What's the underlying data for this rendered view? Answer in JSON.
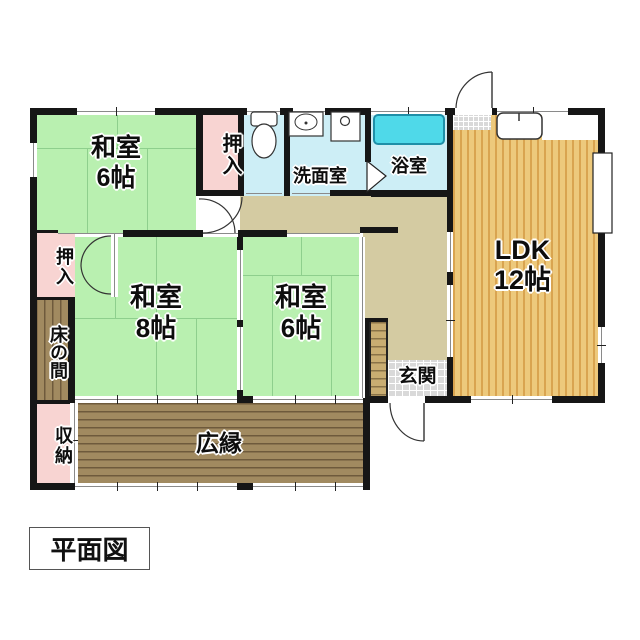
{
  "title_box": {
    "label": "平面図"
  },
  "rooms": {
    "washitsu6_top": {
      "name": "和室",
      "size": "6帖"
    },
    "oshiire_top": {
      "name": "押入"
    },
    "senmenshitsu": {
      "name": "洗面室"
    },
    "yokushitsu": {
      "name": "浴室"
    },
    "ldk": {
      "name": "LDK",
      "size": "12帖"
    },
    "washitsu8": {
      "name": "和室",
      "size": "8帖"
    },
    "washitsu6_mid": {
      "name": "和室",
      "size": "6帖"
    },
    "oshiire_left": {
      "name": "押入"
    },
    "tokonoma": {
      "name": "床の間"
    },
    "shuno": {
      "name": "収納"
    },
    "hiroen": {
      "name": "広縁"
    },
    "genkan": {
      "name": "玄関"
    }
  },
  "colors": {
    "tatami_green": "#b9f0b0",
    "closet_pink": "#f8d4d2",
    "wet_area_blue": "#cdeef6",
    "bathtub_cyan": "#4fd9e9",
    "corridor_tan": "#d4cba2",
    "ldk_floor": "#edc97c",
    "ldk_stripe": "#d9a450",
    "engawa_brown": "#a18a60",
    "wall_black": "#161616"
  }
}
